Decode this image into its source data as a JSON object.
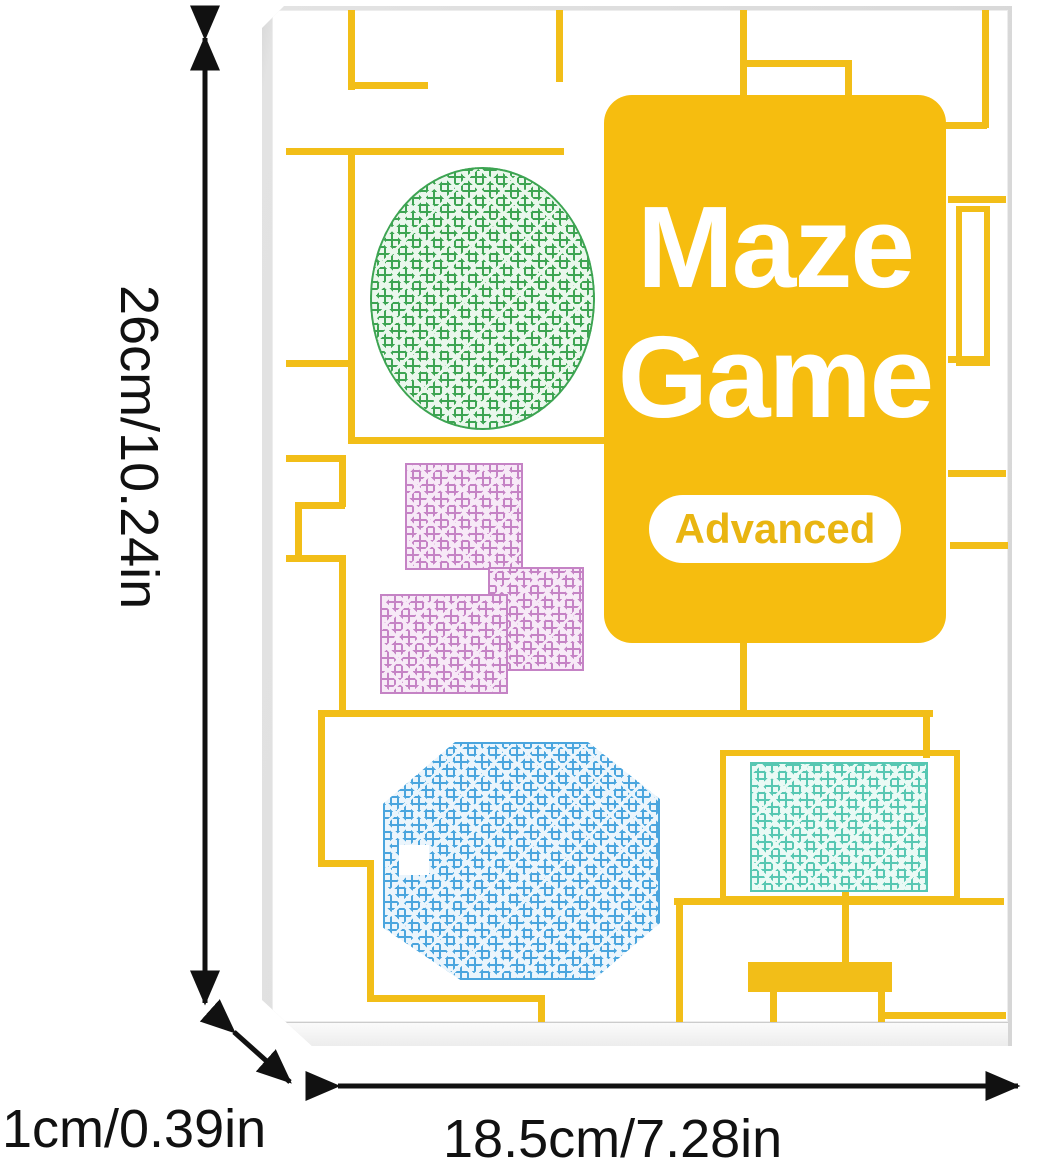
{
  "product": {
    "title_line1": "Maze",
    "title_line2": "Game",
    "badge": "Advanced",
    "cover_shapes": [
      "green-oval-maze",
      "purple-tetris-maze",
      "blue-octagon-maze",
      "teal-rectangle-maze"
    ]
  },
  "dimensions": {
    "height": "26cm/10.24in",
    "depth": "1cm/0.39in",
    "width": "18.5cm/7.28in"
  },
  "colors": {
    "yellow_card": "#F6BD0F",
    "yellow_line": "#F2BE18",
    "badge_text": "#E9B511",
    "green_ink": "#3DA452",
    "green_bg": "#EAF7EC",
    "purple_ink": "#C583C5",
    "purple_bg": "#F7EAF7",
    "blue_ink": "#4AA5DE",
    "blue_bg": "#EBF5FC",
    "teal_ink": "#57C7B2",
    "teal_bg": "#EAFAF5",
    "arrow": "#111111"
  }
}
